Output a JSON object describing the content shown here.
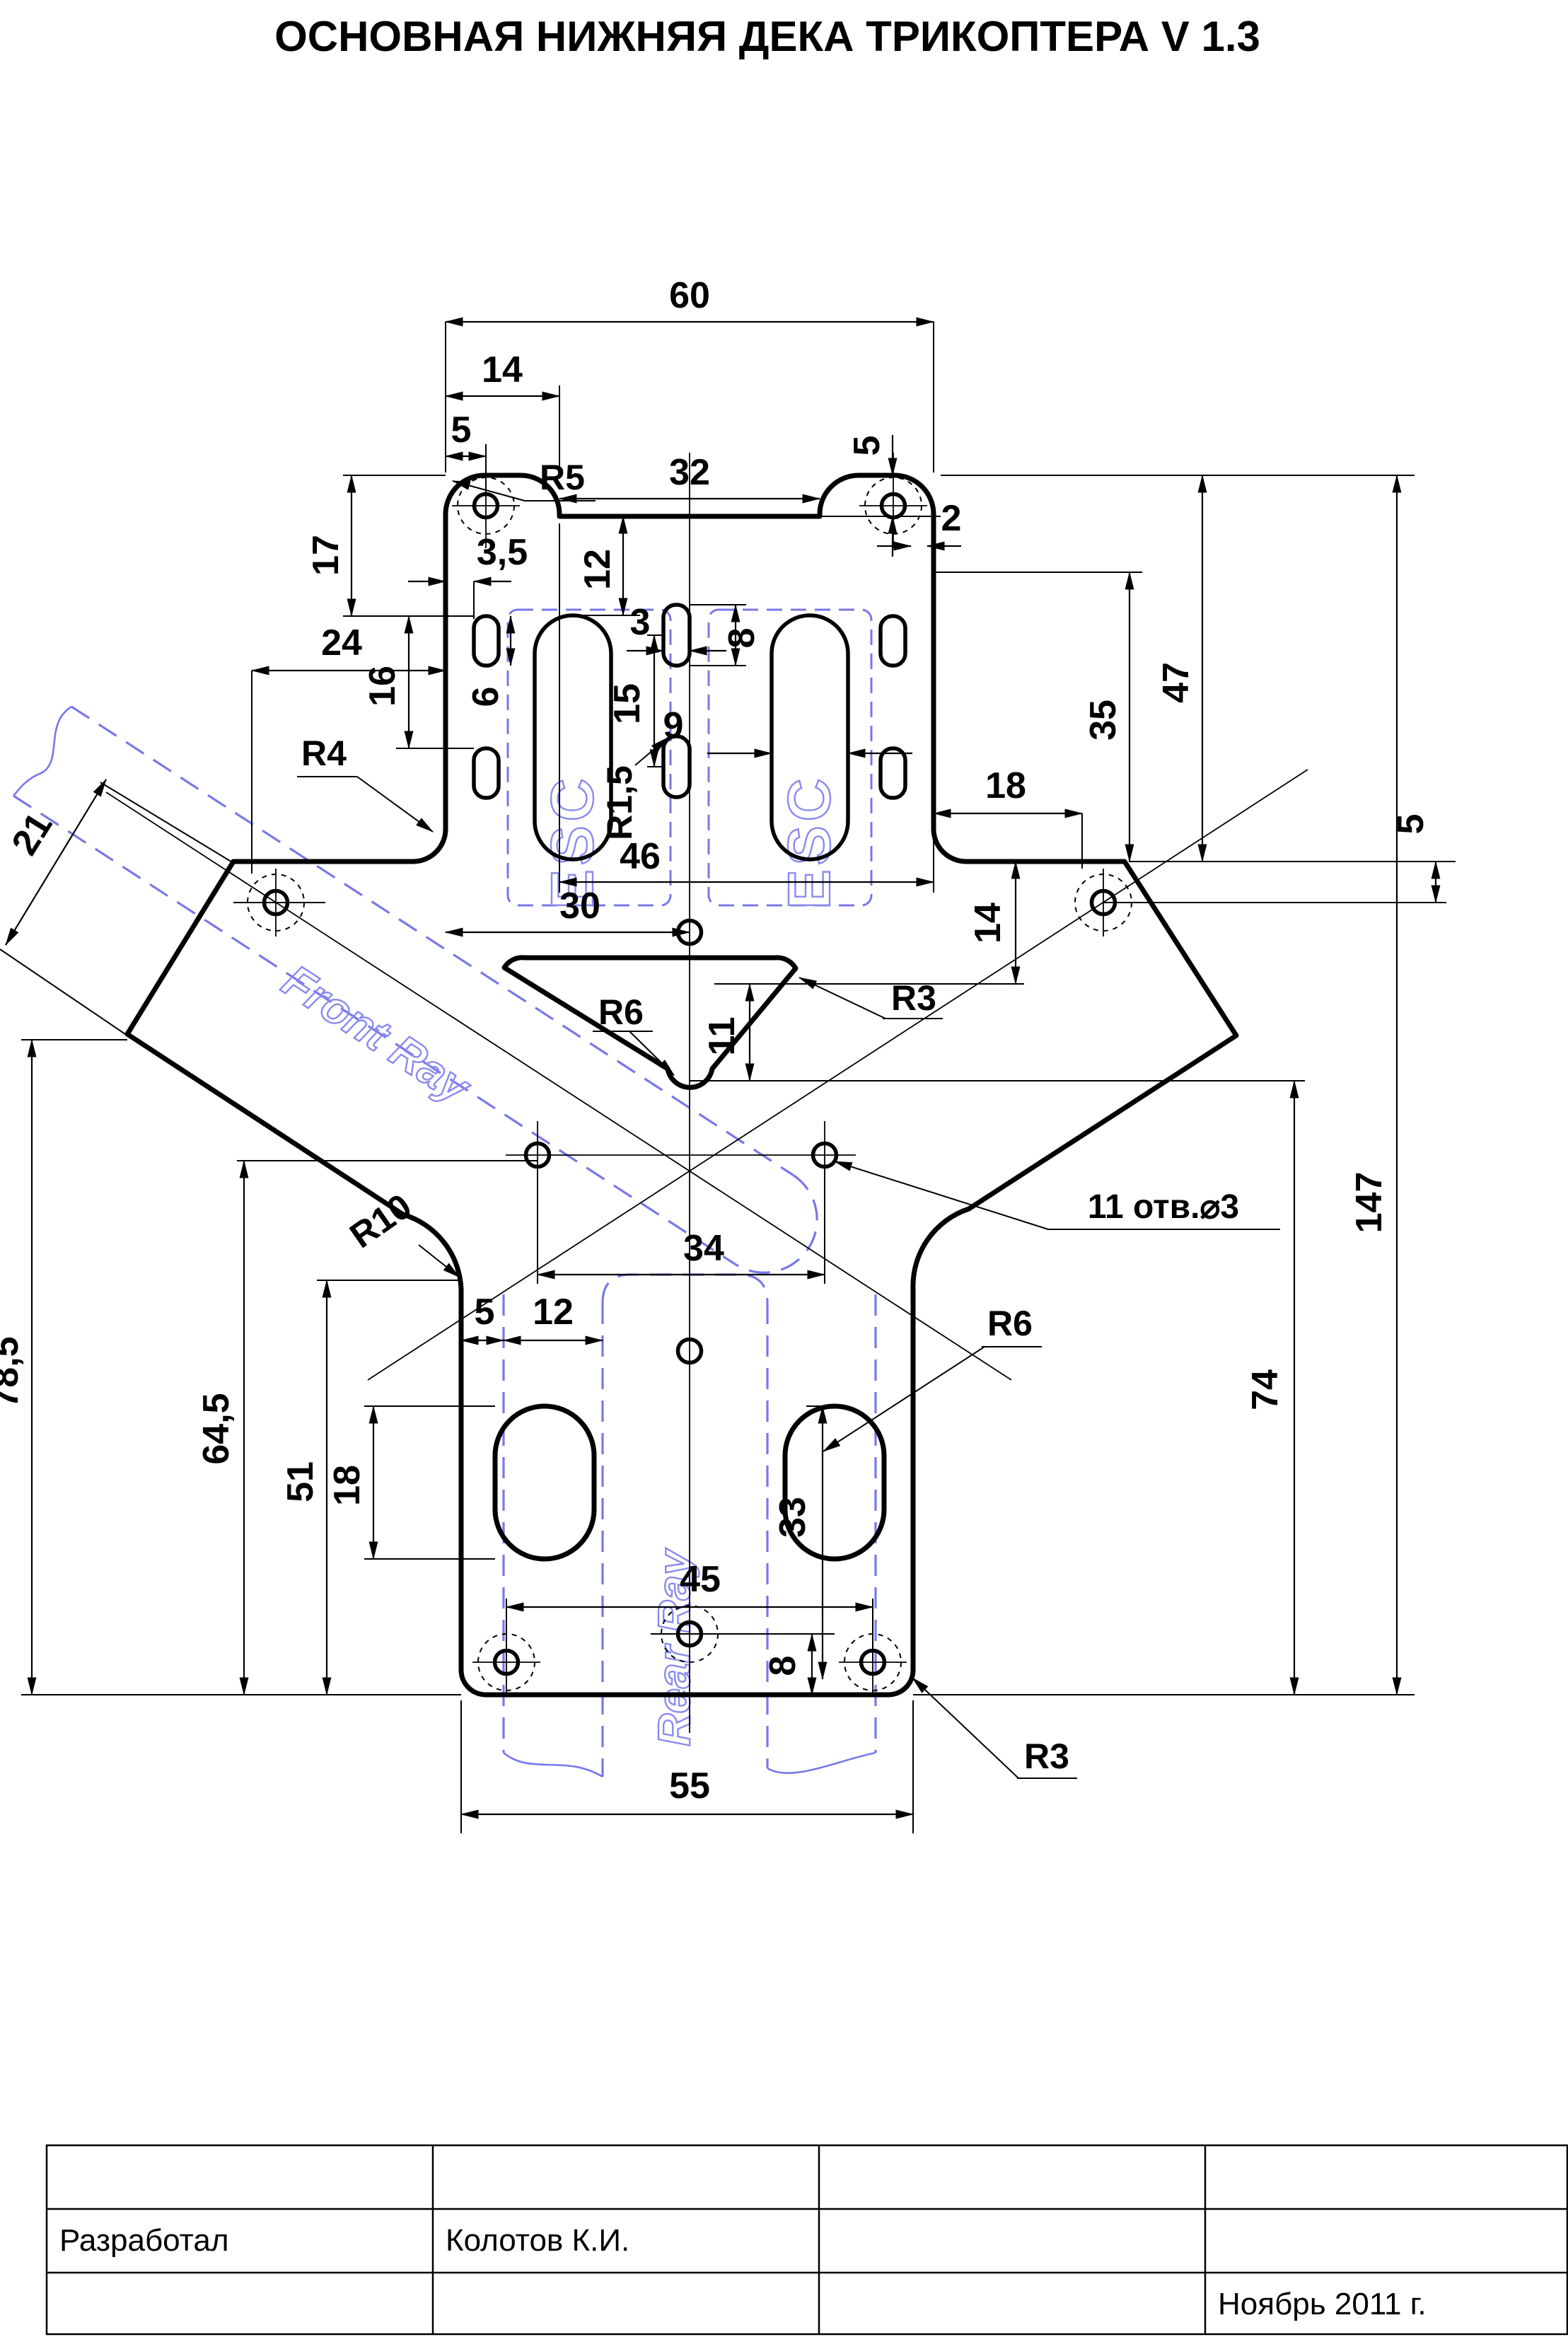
{
  "title": "ОСНОВНАЯ НИЖНЯЯ ДЕКА ТРИКОПТЕРА V 1.3",
  "labels": {
    "esc_left": "ESC",
    "esc_right": "ESC",
    "front_ray": "Front Ray",
    "rear_ray": "Rear Ray"
  },
  "dims": {
    "d60": "60",
    "d14": "14",
    "d5_left": "5",
    "d32": "32",
    "d5_notch": "5",
    "d17": "17",
    "r5": "R5",
    "d2": "2",
    "d12": "12",
    "d3_5": "3,5",
    "d24": "24",
    "d16": "16",
    "d6": "6",
    "d3": "3",
    "d8": "8",
    "d15": "15",
    "d9": "9",
    "r1_5": "R1,5",
    "d47": "47",
    "d35": "35",
    "d18_right": "18",
    "r4": "R4",
    "d46": "46",
    "d30": "30",
    "d5_right": "5",
    "d21": "21",
    "d14_right": "14",
    "r6_triangle": "R6",
    "r3_triangle": "R3",
    "d11": "11",
    "d147": "147",
    "r10": "R10",
    "d34": "34",
    "holes_note": "11 отв.⌀3",
    "d78_5": "78,5",
    "d5_rear": "5",
    "d12_rear": "12",
    "r6_oval": "R6",
    "d64_5": "64,5",
    "d51": "51",
    "d18_rear": "18",
    "d33": "33",
    "d74": "74",
    "d45": "45",
    "d8_rear": "8",
    "r3_corner": "R3",
    "d55": "55"
  },
  "title_block": {
    "developed_label": "Разработал",
    "developer": "Колотов К.И.",
    "date": "Ноябрь 2011 г."
  }
}
